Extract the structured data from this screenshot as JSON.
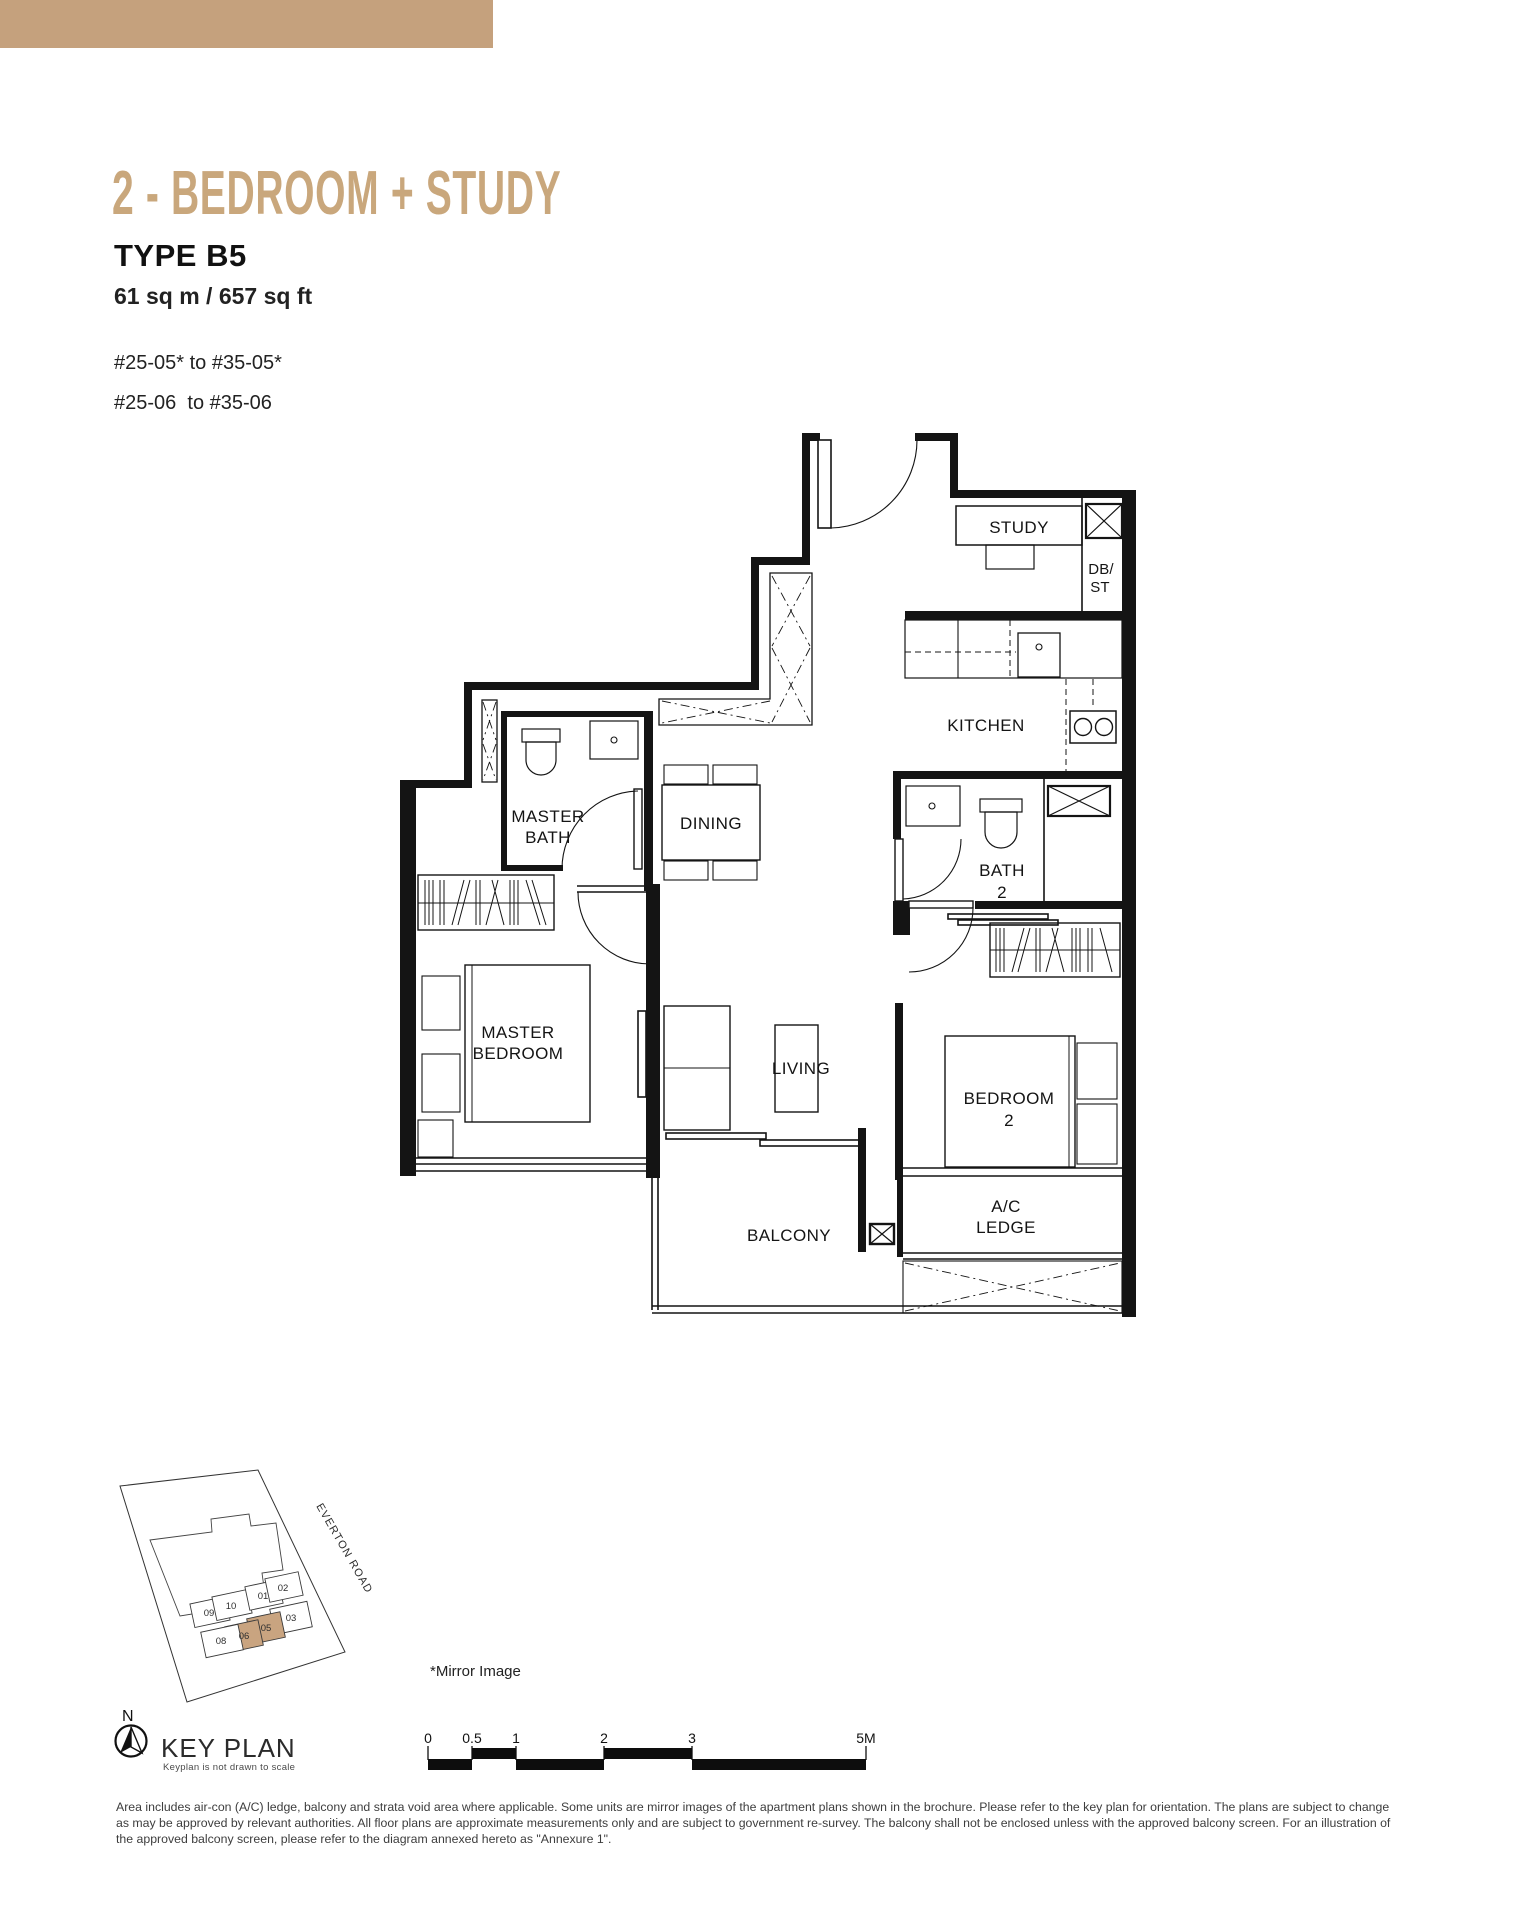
{
  "header": {
    "bar_color": "#C5A17D",
    "title_color": "#C9A77C",
    "title": "2 - BEDROOM + STUDY",
    "type_label": "TYPE B5",
    "area": "61 sq m / 657 sq ft",
    "units": [
      "#25-05* to #35-05*",
      "#25-06  to #35-06"
    ]
  },
  "floorplan": {
    "labels": {
      "study": "STUDY",
      "db": "DB/",
      "st": "ST",
      "kitchen": "KITCHEN",
      "master_bath_1": "MASTER",
      "master_bath_2": "BATH",
      "dining": "DINING",
      "bath2_1": "BATH",
      "bath2_2": "2",
      "master_bedroom_1": "MASTER",
      "master_bedroom_2": "BEDROOM",
      "living": "LIVING",
      "bedroom2_1": "BEDROOM",
      "bedroom2_2": "2",
      "balcony": "BALCONY",
      "ac_1": "A/C",
      "ac_2": "LEDGE"
    }
  },
  "keyplan": {
    "north": "N",
    "title": "KEY PLAN",
    "note": "Keyplan is not drawn to scale",
    "road": "EVERTON ROAD",
    "units": [
      "09",
      "10",
      "01",
      "02",
      "03",
      "05",
      "06",
      "08"
    ],
    "highlighted": [
      "05",
      "06"
    ],
    "highlight_color": "#C9A480"
  },
  "annotations": {
    "mirror": "*Mirror Image"
  },
  "scalebar": {
    "labels": [
      "0",
      "0.5",
      "1",
      "2",
      "3",
      "5M"
    ]
  },
  "disclaimer": {
    "line1": "Area includes air-con (A/C) ledge, balcony and strata void area where applicable. Some units are mirror images of the apartment plans shown in the brochure. Please refer to the key plan for orientation. The plans are subject to change",
    "line2": "as may be approved by relevant authorities. All floor plans are approximate measurements only and are subject to government re-survey. The balcony shall not be enclosed unless with the approved balcony screen. For an illustration of",
    "line3": "the approved balcony screen, please refer to the diagram annexed hereto as \"Annexure 1\"."
  }
}
